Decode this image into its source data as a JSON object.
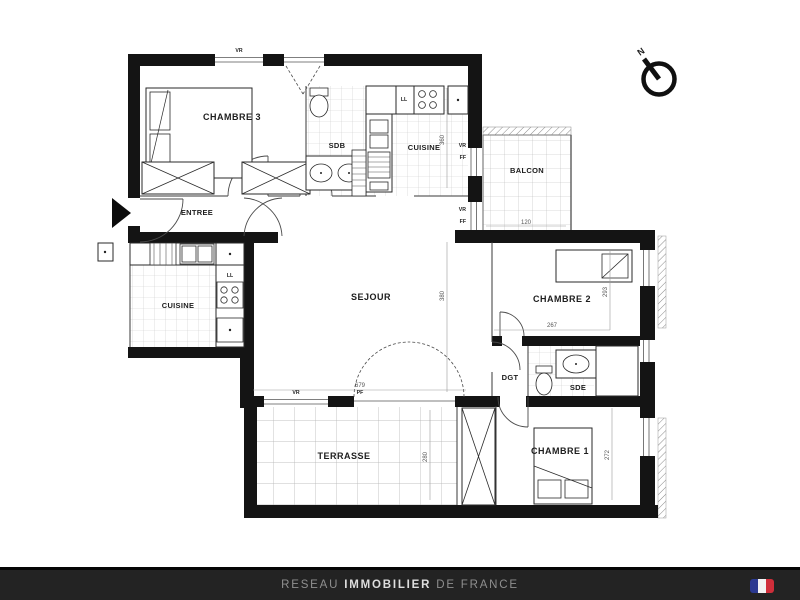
{
  "plan": {
    "rooms": {
      "chambre3": {
        "label": "CHAMBRE 3"
      },
      "sdb": {
        "label": "SDB"
      },
      "cuisine_nord": {
        "label": "CUISINE"
      },
      "balcon": {
        "label": "BALCON"
      },
      "entree": {
        "label": "ENTREE"
      },
      "cuisine_ouest": {
        "label": "CUISINE"
      },
      "sejour": {
        "label": "SEJOUR"
      },
      "chambre2": {
        "label": "CHAMBRE 2"
      },
      "dgt": {
        "label": "DGT"
      },
      "sde": {
        "label": "SDE"
      },
      "chambre1": {
        "label": "CHAMBRE 1"
      },
      "terrasse": {
        "label": "TERRASSE"
      }
    },
    "dimensions": {
      "sejour_width": "679",
      "sejour_height": "380",
      "chambre2_width": "267",
      "chambre2_height": "293",
      "chambre1_height": "272",
      "terrasse_height": "280",
      "cuisine_height": "360",
      "balcon_width": "120"
    },
    "labels": {
      "ll": "LL",
      "vr": "VR",
      "ff": "FF",
      "pf": "PF"
    },
    "compass_north": "N",
    "line_color": "#141414"
  },
  "footer": {
    "brand_prefix": "RESEAU ",
    "brand_highlight": "IMMOBILIER",
    "brand_suffix": " DE FRANCE",
    "background": "#232323",
    "flag_colors": {
      "blue": "#2b3990",
      "white": "#f2f2f2",
      "red": "#cf2e3a"
    }
  }
}
